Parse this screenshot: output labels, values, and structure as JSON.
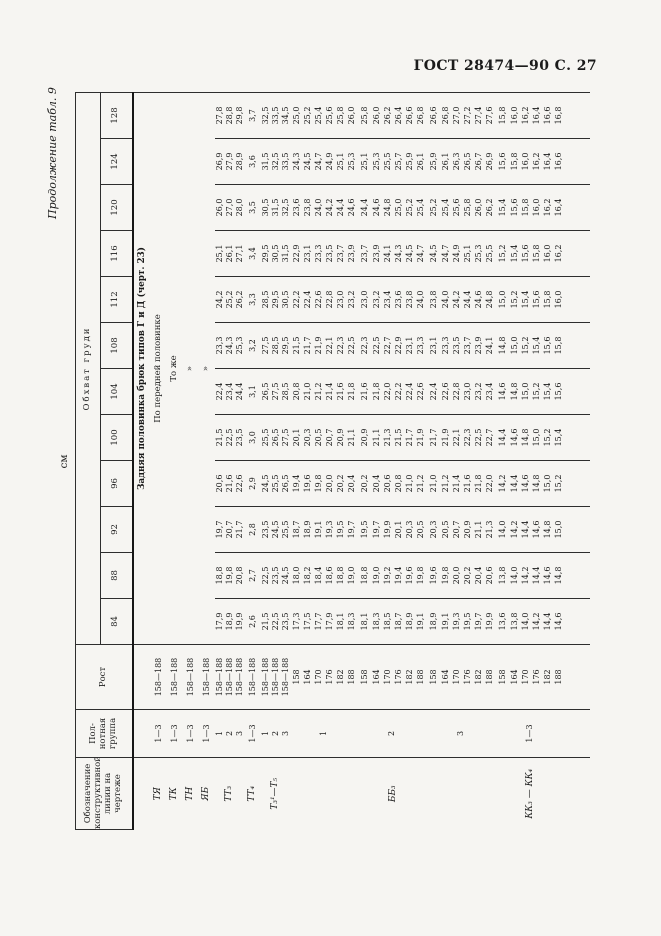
{
  "page": {
    "gost_header": "ГОСТ 28474—90 С. 27",
    "continuation_note": "Продолжение табл. 9",
    "unit_label": "см",
    "colors": {
      "background": "#f6f5f2",
      "ink": "#1b1b1b",
      "rule": "#2e2e2e"
    }
  },
  "table": {
    "col_headers": {
      "designation": "Обозначение конструктивной линии на чертеже",
      "group": "Пол-нотная группа",
      "height": "Рост",
      "chest": "Обхват груди",
      "sizes": [
        "84",
        "88",
        "92",
        "96",
        "100",
        "104",
        "108",
        "112",
        "116",
        "120",
        "124",
        "128"
      ]
    },
    "rows": [
      {
        "h": 18,
        "cells": [
          {
            "t": ""
          },
          {
            "t": ""
          },
          {
            "t": ""
          },
          {
            "t": "Задняя половинка брюк типов Г и Д (черт. 23)",
            "c": 12,
            "cls": "ttl",
            "n": "section-title"
          }
        ]
      },
      {
        "h": 16,
        "cells": [
          {
            "t": "ТЯ",
            "cls": "des"
          },
          {
            "t": "1—3",
            "cls": "grp"
          },
          {
            "t": "158—188",
            "cls": "rost"
          },
          {
            "t": "По передней половинке",
            "c": 12,
            "cls": "spn"
          }
        ]
      },
      {
        "h": 16,
        "cells": [
          {
            "t": "ТК",
            "cls": "des"
          },
          {
            "t": "1—3",
            "cls": "grp"
          },
          {
            "t": "158—188",
            "cls": "rost"
          },
          {
            "t": "То же",
            "c": 12,
            "cls": "spn"
          }
        ]
      },
      {
        "h": 16,
        "cells": [
          {
            "t": "ТН",
            "cls": "des"
          },
          {
            "t": "1—3",
            "cls": "grp"
          },
          {
            "t": "158—188",
            "cls": "rost"
          },
          {
            "t": "»",
            "c": 12,
            "cls": "spn"
          }
        ]
      },
      {
        "h": 16,
        "cells": [
          {
            "t": "ЯБ",
            "cls": "des"
          },
          {
            "t": "1—3",
            "cls": "grp"
          },
          {
            "t": "158—188",
            "cls": "rost"
          },
          {
            "t": "»",
            "c": 12,
            "cls": "spn"
          }
        ]
      },
      {
        "h": 10,
        "cells": [
          {
            "t": "ТТ₃",
            "rs": 3,
            "cls": "des"
          },
          {
            "t": "1",
            "cls": "grp"
          },
          {
            "t": "158—188",
            "cls": "rost"
          }
        ],
        "v": [
          "17,9",
          "18,8",
          "19,7",
          "20,6",
          "21,5",
          "22,4",
          "23,3",
          "24,2",
          "25,1",
          "26,0",
          "26,9",
          "27,8"
        ]
      },
      {
        "h": 10,
        "cells": [
          {
            "t": "2",
            "cls": "grp"
          },
          {
            "t": "158—188",
            "cls": "rost"
          }
        ],
        "v": [
          "18,9",
          "19,8",
          "20,7",
          "21,6",
          "22,5",
          "23,4",
          "24,3",
          "25,2",
          "26,1",
          "27,0",
          "27,9",
          "28,8"
        ]
      },
      {
        "h": 10,
        "cells": [
          {
            "t": "3",
            "cls": "grp"
          },
          {
            "t": "158—188",
            "cls": "rost"
          }
        ],
        "v": [
          "19,9",
          "20,8",
          "21,7",
          "22,6",
          "23,5",
          "24,4",
          "25,3",
          "26,2",
          "27,1",
          "28,0",
          "28,9",
          "29,8"
        ]
      },
      {
        "h": 16,
        "cells": [
          {
            "t": "ТТ₄",
            "cls": "des"
          },
          {
            "t": "1—3",
            "cls": "grp"
          },
          {
            "t": "158—188",
            "cls": "rost"
          }
        ],
        "v": [
          "2,6",
          "2,7",
          "2,8",
          "2,9",
          "3,0",
          "3,1",
          "3,2",
          "3,3",
          "3,4",
          "3,5",
          "3,6",
          "3,7"
        ]
      },
      {
        "h": 10,
        "cells": [
          {
            "t": "Т₃¹—Т₅",
            "rs": 3,
            "cls": "des"
          },
          {
            "t": "1",
            "cls": "grp"
          },
          {
            "t": "158—188",
            "cls": "rost"
          }
        ],
        "v": [
          "21,5",
          "22,5",
          "23,5",
          "24,5",
          "25,5",
          "26,5",
          "27,5",
          "28,5",
          "29,5",
          "30,5",
          "31,5",
          "32,5"
        ]
      },
      {
        "h": 10,
        "cells": [
          {
            "t": "2",
            "cls": "grp"
          },
          {
            "t": "158—188",
            "cls": "rost"
          }
        ],
        "v": [
          "22,5",
          "23,5",
          "24,5",
          "25,5",
          "26,5",
          "27,5",
          "28,5",
          "29,5",
          "30,5",
          "31,5",
          "32,5",
          "33,5"
        ]
      },
      {
        "h": 10,
        "cells": [
          {
            "t": "3",
            "cls": "grp"
          },
          {
            "t": "158—188",
            "cls": "rost"
          }
        ],
        "v": [
          "23,5",
          "24,5",
          "25,5",
          "26,5",
          "27,5",
          "28,5",
          "29,5",
          "30,5",
          "31,5",
          "32,5",
          "33,5",
          "34,5"
        ]
      },
      {
        "h": 12,
        "cells": [
          {
            "t": "ББ₃",
            "rs": 18,
            "cls": "des"
          },
          {
            "t": "1",
            "rs": 6,
            "cls": "grp"
          },
          {
            "t": "158",
            "cls": "rost"
          }
        ],
        "v": [
          "17,3",
          "18,0",
          "18,7",
          "19,4",
          "20,1",
          "20,8",
          "21,5",
          "22,2",
          "22,9",
          "23,6",
          "24,3",
          "25,0"
        ]
      },
      {
        "h": 11,
        "cells": [
          {
            "t": "164",
            "cls": "rost"
          }
        ],
        "v": [
          "17,5",
          "18,2",
          "18,9",
          "19,6",
          "20,3",
          "21,0",
          "21,7",
          "22,4",
          "23,1",
          "23,8",
          "24,5",
          "25,2"
        ]
      },
      {
        "h": 11,
        "cells": [
          {
            "t": "170",
            "cls": "rost"
          }
        ],
        "v": [
          "17,7",
          "18,4",
          "19,1",
          "19,8",
          "20,5",
          "21,2",
          "21,9",
          "22,6",
          "23,3",
          "24,0",
          "24,7",
          "25,4"
        ]
      },
      {
        "h": 11,
        "cells": [
          {
            "t": "176",
            "cls": "rost"
          }
        ],
        "v": [
          "17,9",
          "18,6",
          "19,3",
          "20,0",
          "20,7",
          "21,4",
          "22,1",
          "22,8",
          "23,5",
          "24,2",
          "24,9",
          "25,6"
        ]
      },
      {
        "h": 11,
        "cells": [
          {
            "t": "182",
            "cls": "rost"
          }
        ],
        "v": [
          "18,1",
          "18,8",
          "19,5",
          "20,2",
          "20,9",
          "21,6",
          "22,3",
          "23,0",
          "23,7",
          "24,4",
          "25,1",
          "25,8"
        ]
      },
      {
        "h": 11,
        "cells": [
          {
            "t": "188",
            "cls": "rost"
          }
        ],
        "v": [
          "18,3",
          "19,0",
          "19,7",
          "20,4",
          "21,1",
          "21,8",
          "22,5",
          "23,2",
          "23,9",
          "24,6",
          "25,3",
          "26,0"
        ]
      },
      {
        "h": 14,
        "cells": [
          {
            "t": "2",
            "rs": 6,
            "cls": "grp"
          },
          {
            "t": "158",
            "cls": "rost"
          }
        ],
        "v": [
          "18,1",
          "18,8",
          "19,5",
          "20,2",
          "20,9",
          "21,6",
          "22,3",
          "23,0",
          "23,7",
          "24,4",
          "25,1",
          "25,8"
        ]
      },
      {
        "h": 11,
        "cells": [
          {
            "t": "164",
            "cls": "rost"
          }
        ],
        "v": [
          "18,3",
          "19,0",
          "19,7",
          "20,4",
          "21,1",
          "21,8",
          "22,5",
          "23,2",
          "23,9",
          "24,6",
          "25,3",
          "26,0"
        ]
      },
      {
        "h": 11,
        "cells": [
          {
            "t": "170",
            "cls": "rost"
          }
        ],
        "v": [
          "18,5",
          "19,2",
          "19,9",
          "20,6",
          "21,3",
          "22,0",
          "22,7",
          "23,4",
          "24,1",
          "24,8",
          "25,5",
          "26,2"
        ]
      },
      {
        "h": 11,
        "cells": [
          {
            "t": "176",
            "cls": "rost"
          }
        ],
        "v": [
          "18,7",
          "19,4",
          "20,1",
          "20,8",
          "21,5",
          "22,2",
          "22,9",
          "23,6",
          "24,3",
          "25,0",
          "25,7",
          "26,4"
        ]
      },
      {
        "h": 11,
        "cells": [
          {
            "t": "182",
            "cls": "rost"
          }
        ],
        "v": [
          "18,9",
          "19,6",
          "20,3",
          "21,0",
          "21,7",
          "22,4",
          "23,1",
          "23,8",
          "24,5",
          "25,2",
          "25,9",
          "26,6"
        ]
      },
      {
        "h": 11,
        "cells": [
          {
            "t": "188",
            "cls": "rost"
          }
        ],
        "v": [
          "19,1",
          "19,8",
          "20,5",
          "21,2",
          "21,9",
          "22,6",
          "23,3",
          "24,0",
          "24,7",
          "25,4",
          "26,1",
          "26,8"
        ]
      },
      {
        "h": 14,
        "cells": [
          {
            "t": "3",
            "rs": 6,
            "cls": "grp"
          },
          {
            "t": "158",
            "cls": "rost"
          }
        ],
        "v": [
          "18,9",
          "19,6",
          "20,3",
          "21,0",
          "21,7",
          "22,4",
          "23,1",
          "23,8",
          "24,5",
          "25,2",
          "25,9",
          "26,6"
        ]
      },
      {
        "h": 11,
        "cells": [
          {
            "t": "164",
            "cls": "rost"
          }
        ],
        "v": [
          "19,1",
          "19,8",
          "20,5",
          "21,2",
          "21,9",
          "22,6",
          "23,3",
          "24,0",
          "24,7",
          "25,4",
          "26,1",
          "26,8"
        ]
      },
      {
        "h": 11,
        "cells": [
          {
            "t": "170",
            "cls": "rost"
          }
        ],
        "v": [
          "19,3",
          "20,0",
          "20,7",
          "21,4",
          "22,1",
          "22,8",
          "23,5",
          "24,2",
          "24,9",
          "25,6",
          "26,3",
          "27,0"
        ]
      },
      {
        "h": 11,
        "cells": [
          {
            "t": "176",
            "cls": "rost"
          }
        ],
        "v": [
          "19,5",
          "20,2",
          "20,9",
          "21,6",
          "22,3",
          "23,0",
          "23,7",
          "24,4",
          "25,1",
          "25,8",
          "26,5",
          "27,2"
        ]
      },
      {
        "h": 11,
        "cells": [
          {
            "t": "182",
            "cls": "rost"
          }
        ],
        "v": [
          "19,7",
          "20,4",
          "21,1",
          "21,8",
          "22,5",
          "23,2",
          "23,9",
          "24,6",
          "25,3",
          "26,0",
          "26,7",
          "27,4"
        ]
      },
      {
        "h": 11,
        "cells": [
          {
            "t": "188",
            "cls": "rost"
          }
        ],
        "v": [
          "19,9",
          "20,6",
          "21,3",
          "22,0",
          "22,7",
          "23,4",
          "24,1",
          "24,8",
          "25,5",
          "26,2",
          "26,9",
          "27,6"
        ]
      },
      {
        "h": 14,
        "cells": [
          {
            "t": "КК₃ — КК₄",
            "rs": 6,
            "cls": "des"
          },
          {
            "t": "1—3",
            "rs": 6,
            "cls": "grp"
          },
          {
            "t": "158",
            "cls": "rost"
          }
        ],
        "v": [
          "13,6",
          "13,8",
          "14,0",
          "14,2",
          "14,4",
          "14,6",
          "14,8",
          "15,0",
          "15,2",
          "15,4",
          "15,6",
          "15,8"
        ]
      },
      {
        "h": 11,
        "cells": [
          {
            "t": "164",
            "cls": "rost"
          }
        ],
        "v": [
          "13,8",
          "14,0",
          "14,2",
          "14,4",
          "14,6",
          "14,8",
          "15,0",
          "15,2",
          "15,4",
          "15,6",
          "15,8",
          "16,0"
        ]
      },
      {
        "h": 11,
        "cells": [
          {
            "t": "170",
            "cls": "rost"
          }
        ],
        "v": [
          "14,0",
          "14,2",
          "14,4",
          "14,6",
          "14,8",
          "15,0",
          "15,2",
          "15,4",
          "15,6",
          "15,8",
          "16,0",
          "16,2"
        ]
      },
      {
        "h": 11,
        "cells": [
          {
            "t": "176",
            "cls": "rost"
          }
        ],
        "v": [
          "14,2",
          "14,4",
          "14,6",
          "14,8",
          "15,0",
          "15,2",
          "15,4",
          "15,6",
          "15,8",
          "16,0",
          "16,2",
          "16,4"
        ]
      },
      {
        "h": 11,
        "cells": [
          {
            "t": "182",
            "cls": "rost"
          }
        ],
        "v": [
          "14,4",
          "14,6",
          "14,8",
          "15,0",
          "15,2",
          "15,4",
          "15,6",
          "15,8",
          "16,0",
          "16,2",
          "16,4",
          "16,6"
        ]
      },
      {
        "h": 11,
        "cells": [
          {
            "t": "188",
            "cls": "rost"
          }
        ],
        "v": [
          "14,6",
          "14,8",
          "15,0",
          "15,2",
          "15,4",
          "15,6",
          "15,8",
          "16,0",
          "16,2",
          "16,4",
          "16,6",
          "16,8"
        ]
      },
      {
        "h": 25,
        "cells": [
          {
            "t": ""
          },
          {
            "t": ""
          },
          {
            "t": ""
          },
          {
            "t": ""
          },
          {
            "t": ""
          },
          {
            "t": ""
          },
          {
            "t": ""
          },
          {
            "t": ""
          },
          {
            "t": ""
          },
          {
            "t": ""
          },
          {
            "t": ""
          },
          {
            "t": ""
          },
          {
            "t": ""
          },
          {
            "t": ""
          },
          {
            "t": ""
          }
        ]
      }
    ]
  }
}
